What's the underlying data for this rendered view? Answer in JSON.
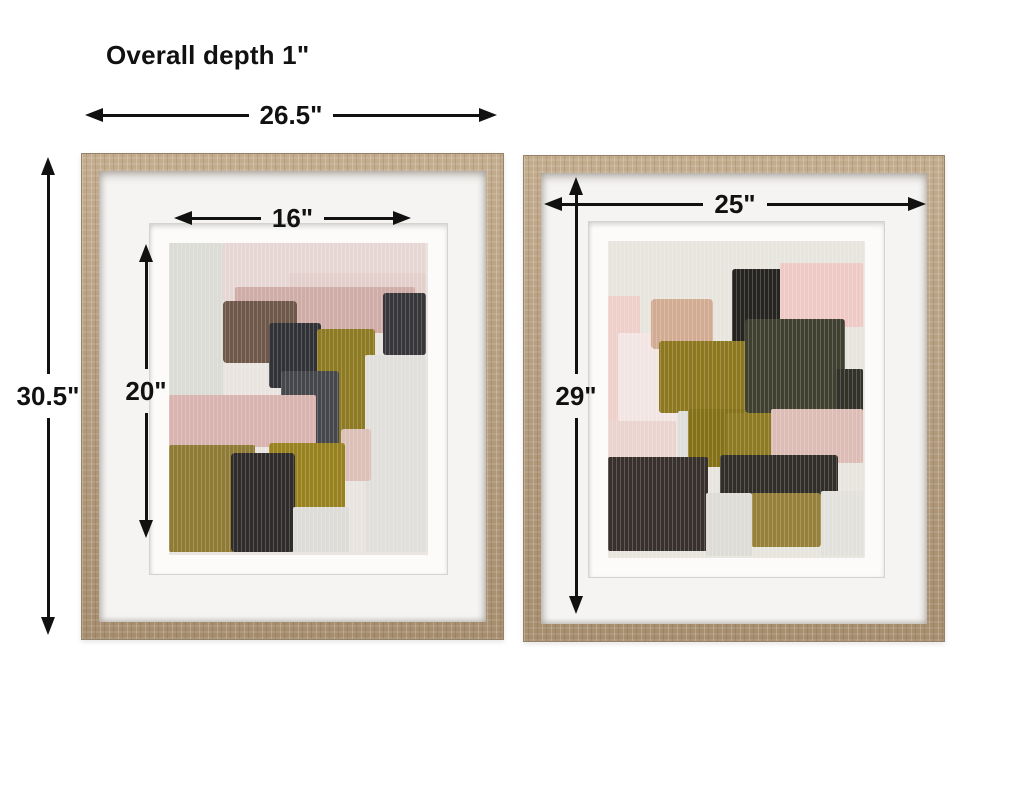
{
  "measurements": {
    "depth": "Overall depth 1\"",
    "overall_width": "26.5\"",
    "overall_height": "30.5\"",
    "left_art_width": "16\"",
    "left_art_height": "20\"",
    "right_width": "25\"",
    "right_height": "29\""
  },
  "colors": {
    "ink": "#111111",
    "page_bg": "#ffffff",
    "mat": "#f5f4f2",
    "wood": "#b29a7c",
    "wood_light": "#c3ac8d",
    "wood_dark": "#a58d6d"
  },
  "artwork": {
    "left": {
      "base": "#e9e4df",
      "patches": [
        {
          "x": 0,
          "y": 0,
          "w": 54,
          "h": 168,
          "c": "#dbdcd6"
        },
        {
          "x": 54,
          "y": 0,
          "w": 203,
          "h": 58,
          "c": "#e7d7d4"
        },
        {
          "x": 120,
          "y": 30,
          "w": 137,
          "h": 56,
          "c": "#e3d0cd"
        },
        {
          "x": 66,
          "y": 44,
          "w": 180,
          "h": 46,
          "c": "#cfaca7"
        },
        {
          "x": 54,
          "y": 58,
          "w": 74,
          "h": 62,
          "c": "#6f5849",
          "r": 4
        },
        {
          "x": 214,
          "y": 50,
          "w": 43,
          "h": 62,
          "c": "#37363a",
          "r": 3
        },
        {
          "x": 100,
          "y": 80,
          "w": 52,
          "h": 65,
          "c": "#303237",
          "r": 3
        },
        {
          "x": 148,
          "y": 86,
          "w": 58,
          "h": 136,
          "c": "#8d7a22",
          "r": 3
        },
        {
          "x": 196,
          "y": 112,
          "w": 61,
          "h": 197,
          "c": "#e0dfdc"
        },
        {
          "x": 112,
          "y": 128,
          "w": 58,
          "h": 88,
          "c": "#45474c",
          "r": 3
        },
        {
          "x": 0,
          "y": 152,
          "w": 147,
          "h": 52,
          "c": "#d8b3af"
        },
        {
          "x": 172,
          "y": 186,
          "w": 30,
          "h": 52,
          "c": "#dcc0b8",
          "r": 3
        },
        {
          "x": 0,
          "y": 202,
          "w": 86,
          "h": 107,
          "c": "#8f7b35"
        },
        {
          "x": 100,
          "y": 200,
          "w": 76,
          "h": 66,
          "c": "#97821f",
          "r": 3
        },
        {
          "x": 62,
          "y": 210,
          "w": 64,
          "h": 99,
          "c": "#2f2c2b",
          "r": 4
        },
        {
          "x": 124,
          "y": 264,
          "w": 56,
          "h": 45,
          "c": "#dedcd8"
        }
      ]
    },
    "right": {
      "base": "#e8e5df",
      "patches": [
        {
          "x": 0,
          "y": 55,
          "w": 32,
          "h": 130,
          "c": "#eecfc9"
        },
        {
          "x": 10,
          "y": 92,
          "w": 58,
          "h": 132,
          "c": "#f3e5e3"
        },
        {
          "x": 0,
          "y": 180,
          "w": 68,
          "h": 60,
          "c": "#ead4cf"
        },
        {
          "x": 43,
          "y": 58,
          "w": 62,
          "h": 50,
          "c": "#d2ab92",
          "r": 4
        },
        {
          "x": 124,
          "y": 28,
          "w": 60,
          "h": 86,
          "c": "#262420",
          "r": 3
        },
        {
          "x": 172,
          "y": 22,
          "w": 83,
          "h": 64,
          "c": "#efc9c6"
        },
        {
          "x": 51,
          "y": 100,
          "w": 88,
          "h": 72,
          "c": "#8d781f",
          "r": 3
        },
        {
          "x": 137,
          "y": 78,
          "w": 100,
          "h": 94,
          "c": "#3f4030",
          "r": 3
        },
        {
          "x": 228,
          "y": 128,
          "w": 27,
          "h": 48,
          "c": "#32312a"
        },
        {
          "x": 70,
          "y": 170,
          "w": 36,
          "h": 52,
          "c": "#dfdeda"
        },
        {
          "x": 80,
          "y": 168,
          "w": 58,
          "h": 58,
          "c": "#857117",
          "r": 3
        },
        {
          "x": 118,
          "y": 172,
          "w": 48,
          "h": 44,
          "c": "#8d7a22"
        },
        {
          "x": 163,
          "y": 168,
          "w": 92,
          "h": 54,
          "c": "#ddbcb6"
        },
        {
          "x": 0,
          "y": 216,
          "w": 100,
          "h": 94,
          "c": "#38302d"
        },
        {
          "x": 112,
          "y": 214,
          "w": 118,
          "h": 42,
          "c": "#312d29",
          "r": 3
        },
        {
          "x": 143,
          "y": 252,
          "w": 70,
          "h": 54,
          "c": "#97803a",
          "r": 3
        },
        {
          "x": 98,
          "y": 252,
          "w": 46,
          "h": 63,
          "c": "#dedcd6"
        },
        {
          "x": 213,
          "y": 250,
          "w": 42,
          "h": 65,
          "c": "#e3e1dc"
        }
      ]
    }
  }
}
